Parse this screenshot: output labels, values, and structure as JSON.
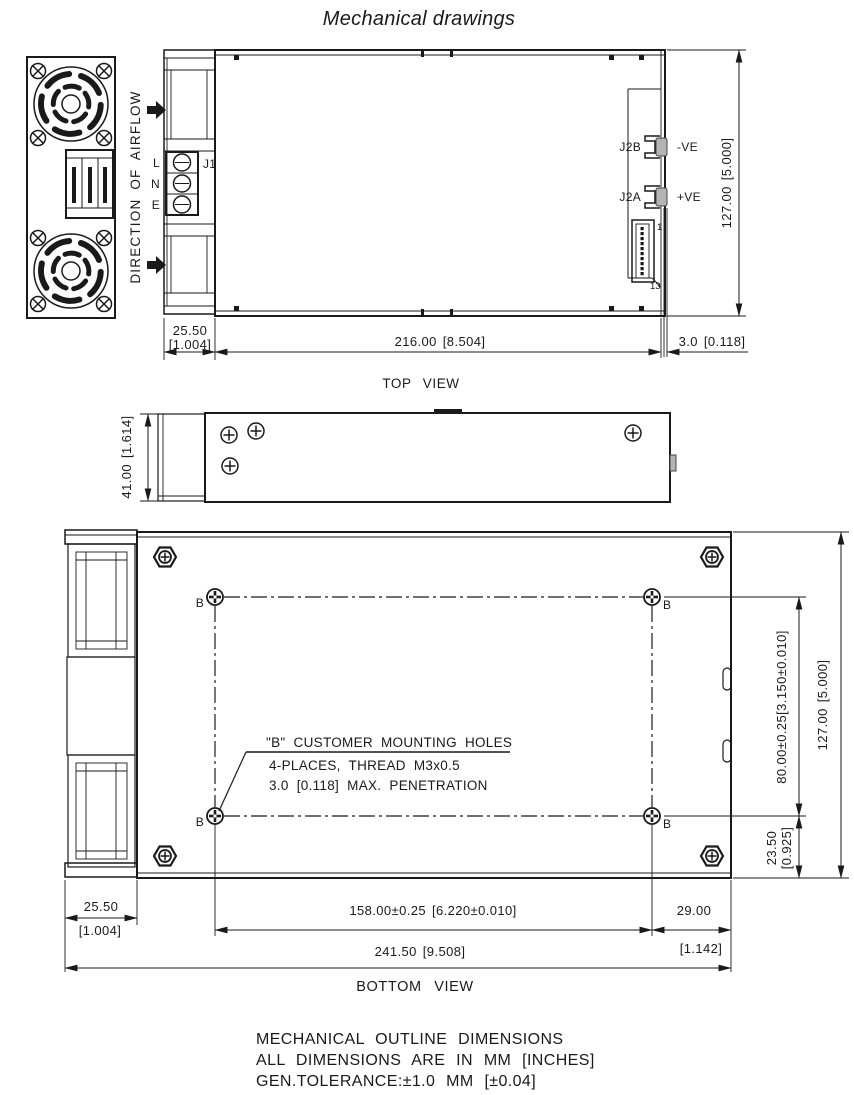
{
  "title": "Mechanical drawings",
  "airflow_label": "DIRECTION OF AIRFLOW",
  "top_view": {
    "caption": "TOP VIEW",
    "terminal_labels": {
      "j1": "J1",
      "line": "L",
      "neutral": "N",
      "earth": "E"
    },
    "connectors": {
      "j2b": "J2B",
      "j2b_polarity": "-VE",
      "j2a": "J2A",
      "j2a_polarity": "+VE",
      "pin_first": "1",
      "pin_last": "13"
    },
    "dims": {
      "overall_width": "127.00 [5.000]",
      "front_section_mm": "25.50",
      "front_section_in": "[1.004]",
      "body_length": "216.00 [8.504]",
      "busbar_protrusion": "3.0 [0.118]"
    }
  },
  "side_view": {
    "dims": {
      "height": "41.00 [1.614]"
    }
  },
  "bottom_view": {
    "caption": "BOTTOM VIEW",
    "hole_label": "B",
    "note_line1": "\"B\" CUSTOMER MOUNTING HOLES",
    "note_line2": "4-PLACES, THREAD M3x0.5",
    "note_line3": "3.0 [0.118] MAX. PENETRATION",
    "dims": {
      "hole_span_vertical": "80.00±0.25[3.150±0.010]",
      "overall_width": "127.00 [5.000]",
      "hole_bottom_offset_mm": "23.50",
      "hole_bottom_offset_in": "[0.925]",
      "front_section_mm": "25.50",
      "front_section_in": "[1.004]",
      "hole_span_horizontal": "158.00±0.25 [6.220±0.010]",
      "hole_right_offset_mm": "29.00",
      "hole_right_offset_in": "[1.142]",
      "overall_length": "241.50 [9.508]"
    }
  },
  "footer": {
    "line1": "MECHANICAL OUTLINE DIMENSIONS",
    "line2": "ALL DIMENSIONS ARE IN MM [INCHES]",
    "line3": "GEN.TOLERANCE:±1.0 MM [±0.04]"
  }
}
